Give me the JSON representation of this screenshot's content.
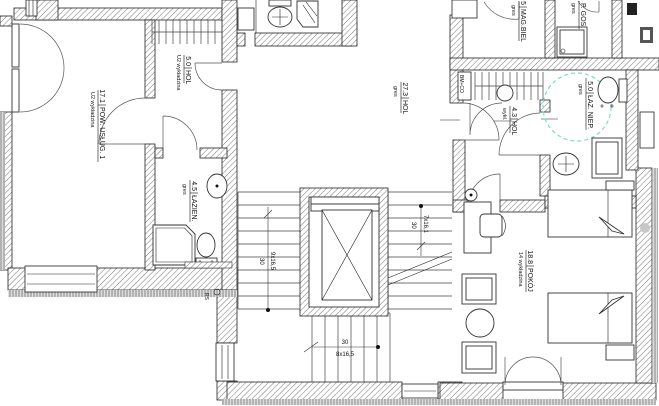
{
  "drawing": {
    "kind": "architectural floor plan",
    "colors": {
      "turning_circle_accent": "#7fd9cf",
      "line": "#1a1a1a",
      "wall_hatch": "#777777"
    }
  },
  "rooms": [
    {
      "id": "pow-uslug-1",
      "area": "17.1",
      "name": "POW. USŁUG. 1",
      "finish": "U2 wykładzina"
    },
    {
      "id": "hol-5",
      "area": "5.0",
      "name": "HOL",
      "finish": "U2 wykładzina"
    },
    {
      "id": "lazienka",
      "area": "4.5",
      "name": "ŁAZIEN.",
      "finish": "gres"
    },
    {
      "id": "hol-27",
      "area": "27.3",
      "name": "HOL",
      "finish": "gres"
    },
    {
      "id": "mag-biel",
      "area": "5",
      "name": "MAG.BIEL",
      "finish": "gres"
    },
    {
      "id": "p-gos",
      "area": "",
      "name": "P. GOS.",
      "finish": "gres"
    },
    {
      "id": "hol-43",
      "area": "4.3",
      "name": "HOL",
      "finish": "wykł."
    },
    {
      "id": "laz-niep",
      "area": "5.0",
      "name": "ŁAZ. NIEP.",
      "finish": "gres"
    },
    {
      "id": "pokoj",
      "area": "18.8",
      "name": "POKÓJ",
      "finish": "14 wykładzina"
    }
  ],
  "dimensions": {
    "stairs_left_run": "9x16,5",
    "stairs_left_width": "30",
    "stairs_right_run": "7x16,1",
    "stairs_right_width": "30",
    "stairs_bottom_run": "8x16,5",
    "stairs_bottom_width": "30"
  },
  "annotations": {
    "riser_label": "RS",
    "shaft_label": "BM+CO"
  }
}
